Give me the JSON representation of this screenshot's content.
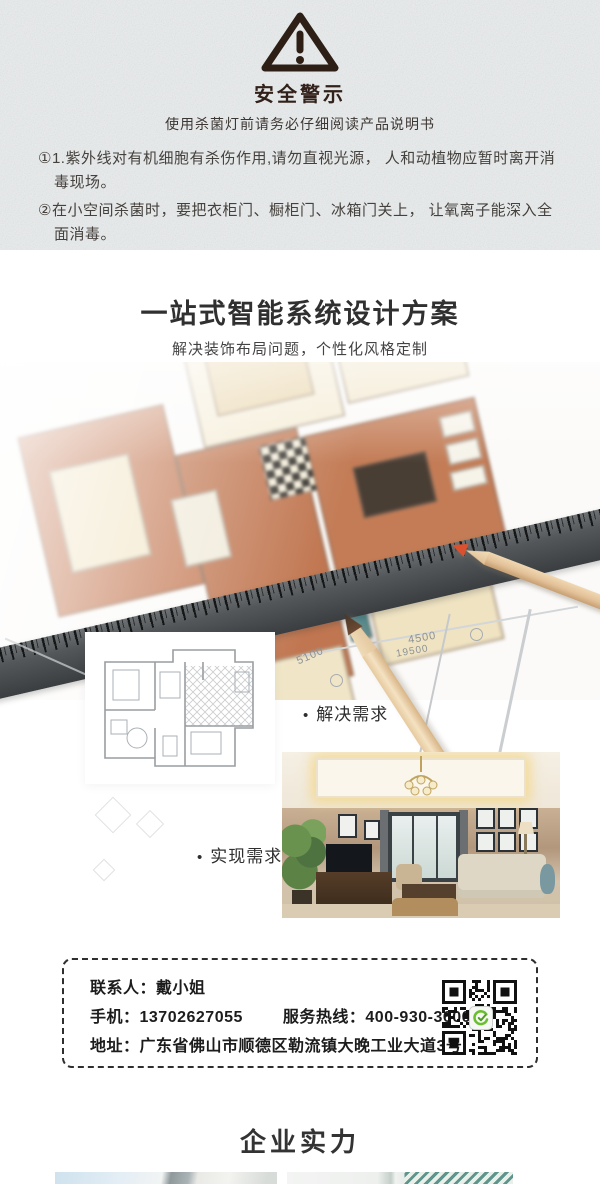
{
  "safety": {
    "title": "安全警示",
    "subtitle": "使用杀菌灯前请务必仔细阅读产品说明书",
    "warnings": [
      "①1.紫外线对有机细胞有杀伤作用,请勿直视光源， 人和动植物应暂时离开消毒现场。",
      "②在小空间杀菌时，要把衣柜门、橱柜门、冰箱门关上， 让氧离子能深入全面消毒。"
    ]
  },
  "design": {
    "title": "一站式智能系统设计方案",
    "subtitle": "解决装饰布局问题，个性化风格定制",
    "bullet": "•",
    "label_need": "解决需求",
    "label_result": "实现需求",
    "dims": {
      "a": "5100",
      "b": "4500",
      "c": "19500"
    }
  },
  "contact": {
    "person": "联系人：戴小姐",
    "phone": "手机：13702627055",
    "hotline": "服务热线：400-930-3600",
    "address": "地址：广东省佛山市顺德区勒流镇大晚工业大道3号"
  },
  "strength": {
    "title": "企业实力"
  },
  "colors": {
    "accent_green": "#6abf2f",
    "qr_black": "#111111",
    "texture_bg": "#e9eced",
    "warning_dark": "#32211a"
  }
}
